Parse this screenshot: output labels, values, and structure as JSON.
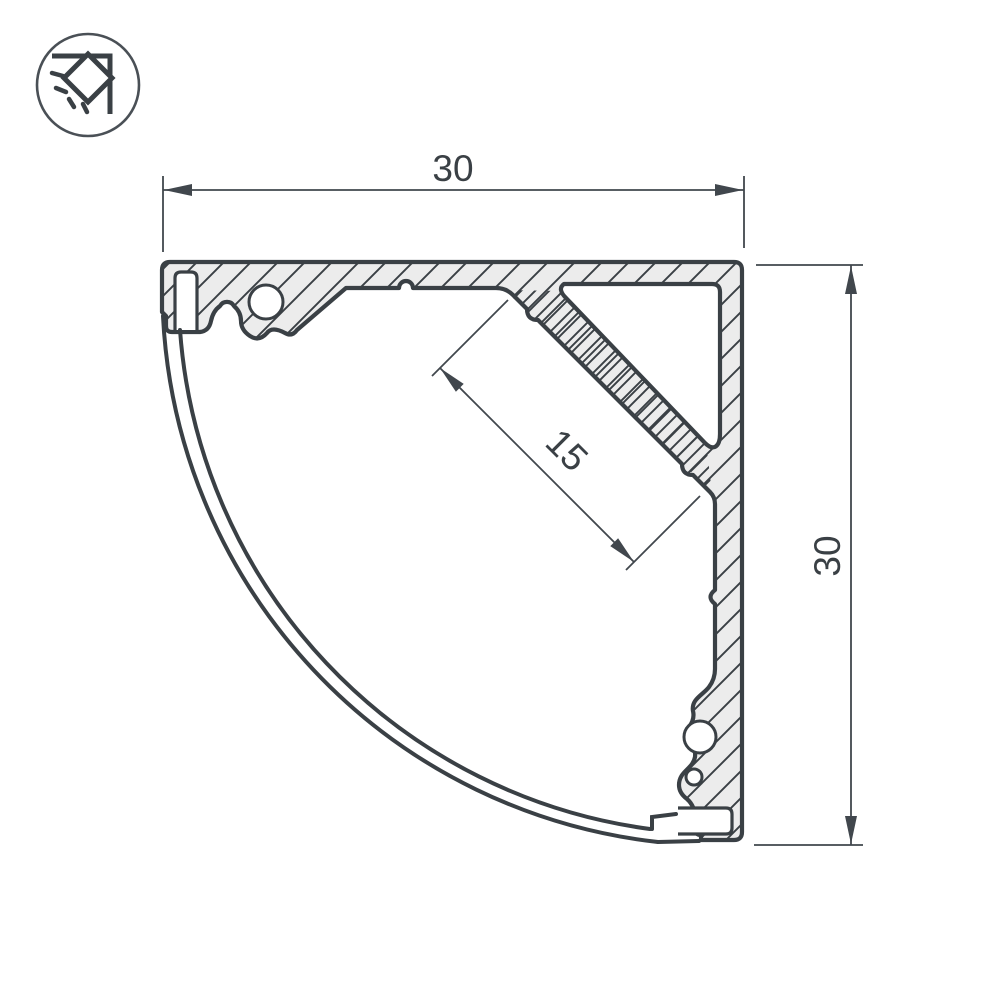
{
  "drawing": {
    "colors": {
      "line": "#3a4045",
      "dim": "#41474d",
      "fill_light": "#ececec",
      "background": "#ffffff"
    },
    "icon": {
      "name": "corner-light-icon"
    },
    "dimensions": {
      "top_width": {
        "label": "30"
      },
      "right_height": {
        "label": "30"
      },
      "led_shelf": {
        "label": "15"
      }
    }
  }
}
